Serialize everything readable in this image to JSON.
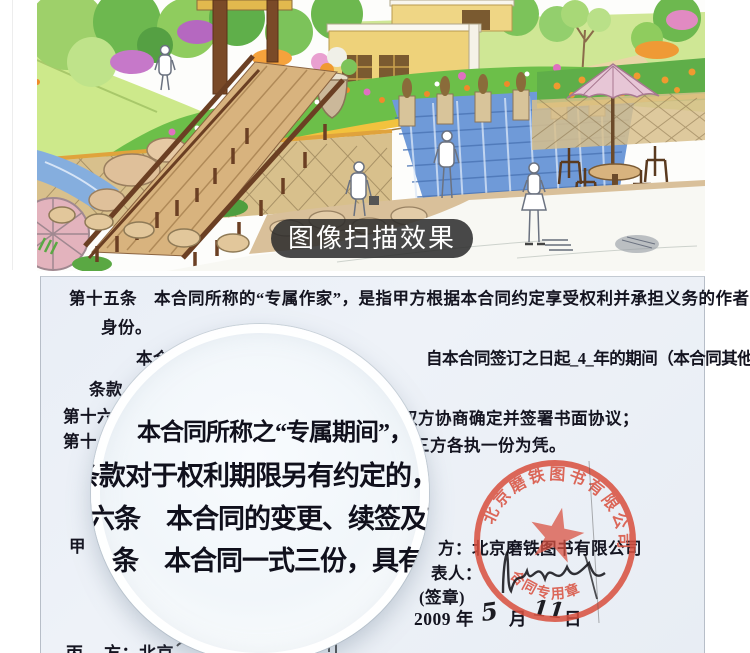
{
  "overlay_label": {
    "text": "图像扫描效果",
    "bg_color": "#2b2b2b"
  },
  "illustration": {
    "name": "hand-drawn-garden-landscape-scan",
    "alt": "彩色手绘园林景观效果图（扫描件）",
    "palette": {
      "lawn": "#cde98b",
      "tree": "#6db84f",
      "wall_yellow": "#f0c23e",
      "water": "#6f9ad8",
      "wood": "#7a4a28",
      "stone": "#dcc29a"
    }
  },
  "document": {
    "bg_color": "#edf2f8",
    "lines": {
      "l1": "第十五条　本合同所称的“专属作家”，是指甲方根据本合同约定享受权利并承担义务的作者",
      "l2": "身份。",
      "l3_left": "本合同所称的“专属作",
      "l3_right": "自本合同签订之日起_4_年的期间（本合同其他",
      "l4": "条款。",
      "l5_left": "第十六",
      "l5_right": "双方协商确定并签署书面协议；",
      "l6_left": "第十",
      "l6_right": "三方各执一份为凭。",
      "l7_left": "甲",
      "l7_right": "方：北京磨铁图书有限公司",
      "l8": "表人：",
      "l9": "(签章)",
      "l11_left": "丙",
      "l11_right": "方：北京"
    },
    "date": {
      "year": "2009 年",
      "month_value": "5",
      "month_label": "月",
      "day_value": "11",
      "day_label": "日"
    }
  },
  "magnifier": {
    "m1": "本合同所称之“专属期间”，",
    "m2": "条款对于权利期限另有约定的，从其",
    "m3": "六条　本合同的变更、续签及其他未尽",
    "m4": "条　本合同一式三份，具有同等的"
  },
  "stamp": {
    "ring_text": "北京磨铁图书有限公司",
    "bottom_text": "合同专用章",
    "color": "#d9503f"
  }
}
